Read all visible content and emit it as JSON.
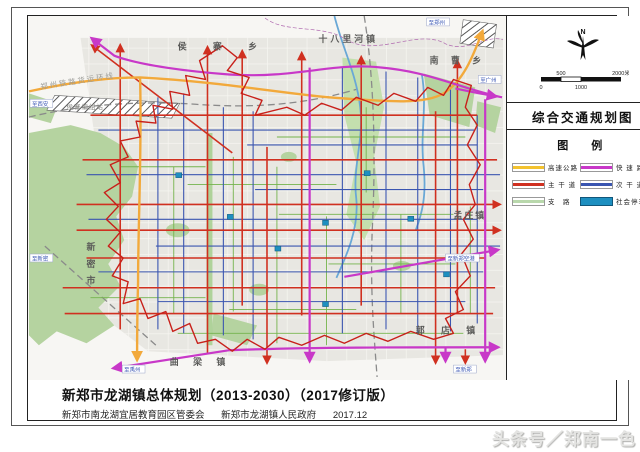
{
  "page": {
    "title_block": {
      "line1": "新郑市龙湖镇总体规划（2013-2030）（2017修订版）",
      "line2_left": "新郑市南龙湖宜居教育园区管委会",
      "line2_mid": "新郑市龙湖镇人民政府",
      "line2_date": "2017.12"
    },
    "watermark": "头条号／郑南一色"
  },
  "panel": {
    "north_label": "N",
    "scale": {
      "ticks": [
        "0",
        "500",
        "1000",
        "2000米"
      ]
    },
    "map_title": "综合交通规划图",
    "legend_title": "图　例",
    "legend": [
      {
        "label": "高速公路",
        "color": "#f3c22e",
        "type": "line"
      },
      {
        "label": "快 速 路",
        "color": "#c838c8",
        "type": "line"
      },
      {
        "label": "主 干 道",
        "color": "#d03020",
        "type": "line"
      },
      {
        "label": "次 干 道",
        "color": "#3a55b0",
        "type": "line"
      },
      {
        "label": "支　路",
        "color": "#b9d8ac",
        "type": "line"
      },
      {
        "label": "社会停车场",
        "color": "#1d8fc0",
        "type": "box"
      }
    ]
  },
  "map": {
    "towns": [
      {
        "text": "侯 寨 乡"
      },
      {
        "text": "十八里河镇"
      },
      {
        "text": "南 曹 乡"
      },
      {
        "text": "孟庄镇"
      },
      {
        "text": "郭 店 镇"
      },
      {
        "text": "曲 梁 镇"
      },
      {
        "text": "新密市"
      }
    ],
    "rail_labels": [
      {
        "text": "郑州铁路货运环线"
      },
      {
        "text": "侯寨编组站"
      }
    ],
    "edge_labels": [
      {
        "text": "至郑州"
      },
      {
        "text": "至广州"
      },
      {
        "text": "至新郑空港"
      },
      {
        "text": "至新郑"
      },
      {
        "text": "至禹州"
      },
      {
        "text": "至新密"
      },
      {
        "text": "至西安"
      }
    ]
  },
  "colors": {
    "highway": "#f3c22e",
    "expressway": "#c838c8",
    "arterial": "#d03020",
    "secondary": "#3a55b0",
    "branch": "#74b34c",
    "parking": "#1d8fc0",
    "boundary": "#c8201a",
    "green_land": "#b5d3a0",
    "river": "#69a8d6",
    "railway": "#8a8a8a"
  }
}
